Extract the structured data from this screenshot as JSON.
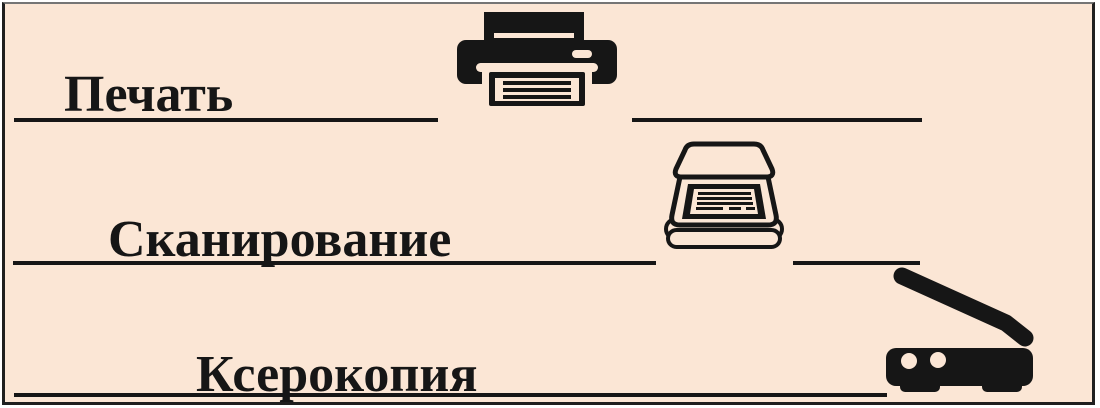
{
  "canvas": {
    "background_color": "#fbe6d5",
    "ink_color": "#161616",
    "frame_border_color": "#1f1f1f"
  },
  "rows": [
    {
      "label": "Печать",
      "icon": "printer-icon"
    },
    {
      "label": "Сканирование",
      "icon": "scanner-icon"
    },
    {
      "label": "Ксерокопия",
      "icon": "copier-icon"
    }
  ]
}
